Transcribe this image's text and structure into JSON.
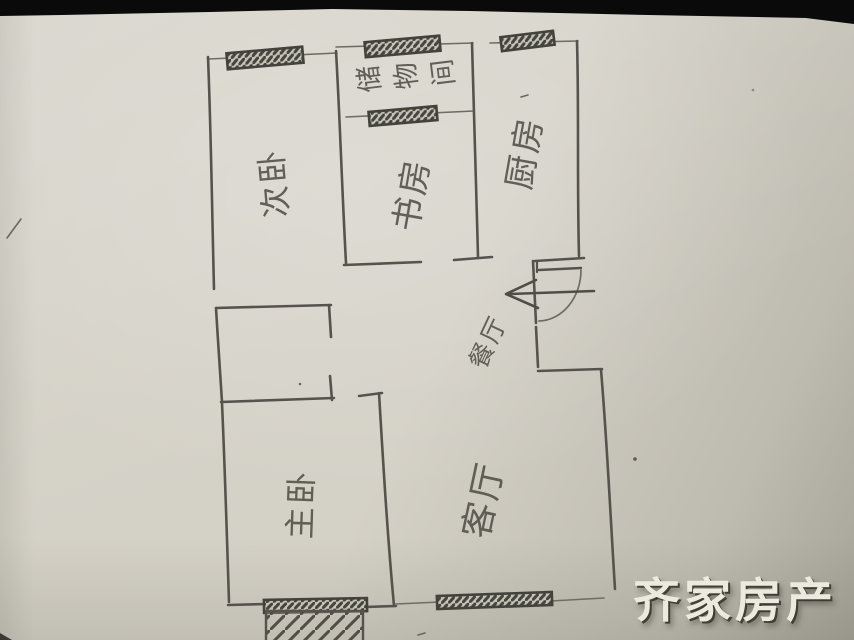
{
  "watermark": {
    "text": "齐家房产",
    "color": "#eceadf",
    "shadow_color": "#323129"
  },
  "floorplan": {
    "rooms": [
      {
        "id": "ciwo",
        "label": "次卧"
      },
      {
        "id": "shufang",
        "label": "书房"
      },
      {
        "id": "chuwujian",
        "label": "储物间"
      },
      {
        "id": "chufang",
        "label": "厨房"
      },
      {
        "id": "canting",
        "label": "餐厅"
      },
      {
        "id": "zhuwo",
        "label": "主卧"
      },
      {
        "id": "keting",
        "label": "客厅"
      }
    ],
    "features": {
      "entry_arrow": "left-arrow",
      "entry_door": "door-swing-arc",
      "window_count": 6,
      "balcony_hatched": true
    },
    "colors": {
      "pencil": "#55534c",
      "paper": "#d4d1c7",
      "hatch": "#45443d"
    }
  }
}
